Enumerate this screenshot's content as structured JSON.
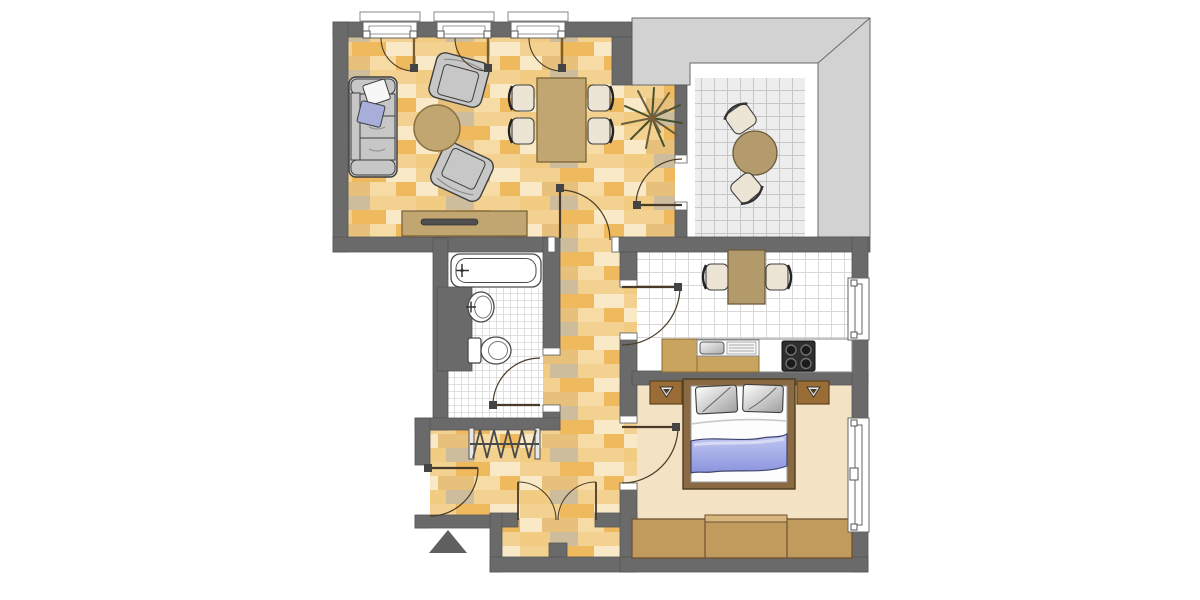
{
  "document": {
    "kind": "apartment-floor-plan",
    "text_labels": []
  },
  "palette": {
    "wall": "#6a6a6a",
    "wall_line": "#565656",
    "parapet": "#d2d2d2",
    "parapet_line": "#6a6a6a",
    "parquet_base": "#f6dca4",
    "parquet_planks": [
      "#efb95d",
      "#f3d291",
      "#e7c07b",
      "#cdbd9d",
      "#f9e9c6",
      "#f3cc84"
    ],
    "tile_white": "#ffffff",
    "tile_grid": "#d8d8d8",
    "balcony_tile": "#ededed",
    "balcony_grid": "#c6c6c6",
    "carpet": "#f3e2c4",
    "gray_furn": "#c7c7c7",
    "outline": "#3e3e3e",
    "wood_tan": "#c2a672",
    "wood_dark": "#7a6335",
    "cabinet_tan": "#c8a45f",
    "cabinet_dark": "#8a6b35",
    "bed_brown": "#8a6a42",
    "bed_dark": "#4e3a20",
    "nightstand": "#9b6d36",
    "wardrobe": "#c19a5e",
    "wardrobe_dark": "#6e5130",
    "blanket_line": "#41466e",
    "pillow_blue": "#a6aed9",
    "chair_cream": "#ece4d4",
    "chair_line": "#3f3f3f",
    "stove": "#2e2e2e",
    "arc_line": "#4a3b28",
    "fixture": "#4a4a4a",
    "plant_a": "#45502e",
    "plant_b": "#6b5f3e",
    "triangle": "#5f5f5f"
  },
  "rooms": [
    {
      "id": "living-room",
      "floor": "parquet"
    },
    {
      "id": "balcony",
      "floor": "tile"
    },
    {
      "id": "kitchen",
      "floor": "tile"
    },
    {
      "id": "bathroom",
      "floor": "tile"
    },
    {
      "id": "bedroom",
      "floor": "carpet"
    },
    {
      "id": "hallway",
      "floor": "parquet"
    },
    {
      "id": "closet-niche",
      "floor": "parquet"
    }
  ],
  "furniture": [
    "sofa",
    "armchair",
    "armchair",
    "coffee-table",
    "dining-table",
    "dining-chairs-4",
    "sideboard",
    "plant",
    "balcony-table",
    "balcony-chairs-2",
    "kitchen-table",
    "kitchen-chairs-2",
    "kitchen-counter",
    "sink-unit",
    "stove",
    "bathtub",
    "washbasin",
    "toilet",
    "coat-rack",
    "double-bed",
    "nightstand",
    "nightstand",
    "wardrobe"
  ]
}
